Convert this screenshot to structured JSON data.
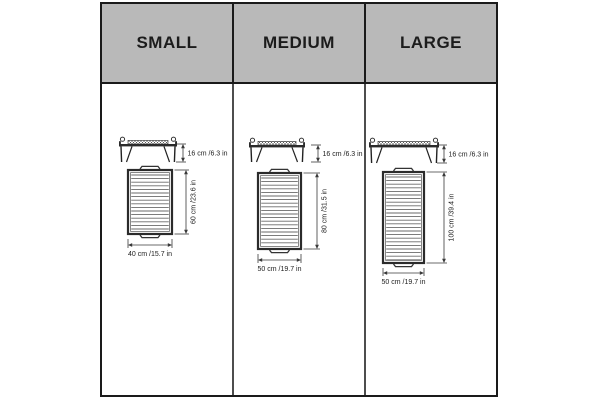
{
  "sizes": [
    {
      "name": "SMALL",
      "height_label": "16 cm /6.3 in",
      "length_label": "60 cm /23.6 in",
      "width_label": "40 cm /15.7 in",
      "height_cm": 16,
      "height_in": 6.3,
      "length_cm": 60,
      "length_in": 23.6,
      "width_cm": 40,
      "width_in": 15.7
    },
    {
      "name": "MEDIUM",
      "height_label": "16 cm /6.3 in",
      "length_label": "80 cm /31.5 in",
      "width_label": "50 cm /19.7 in",
      "height_cm": 16,
      "height_in": 6.3,
      "length_cm": 80,
      "length_in": 31.5,
      "width_cm": 50,
      "width_in": 19.7
    },
    {
      "name": "LARGE",
      "height_label": "16 cm /6.3 in",
      "length_label": "100 cm /39.4 in",
      "width_label": "50 cm /19.7 in",
      "height_cm": 16,
      "height_in": 6.3,
      "length_cm": 100,
      "length_in": 39.4,
      "width_cm": 50,
      "width_in": 19.7
    }
  ],
  "colors": {
    "header_bg": "#b9b9b9",
    "table_border": "#1a1a1a",
    "body_divider": "#4d4d4d",
    "drawing": "#2b2b2b",
    "grate_line": "#6a6a6a",
    "dim_line": "#3a3a3a",
    "text": "#1c1c1c"
  }
}
